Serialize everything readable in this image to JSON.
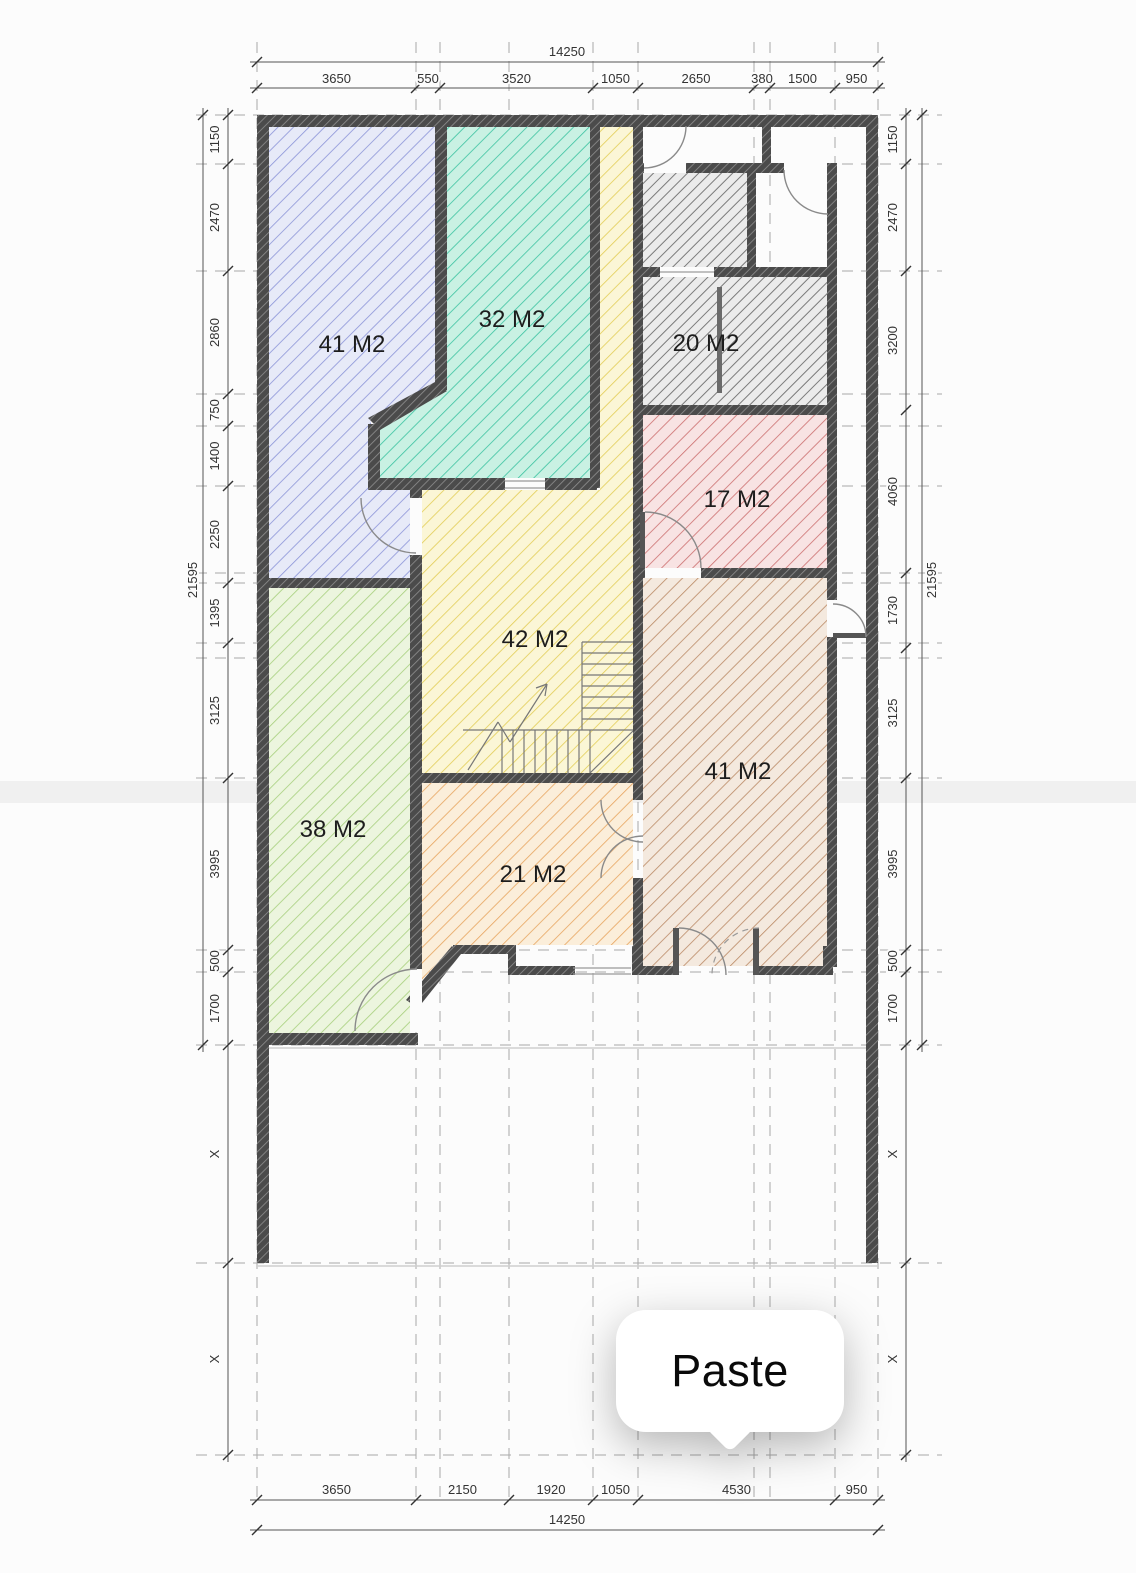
{
  "page": {
    "background": "#fcfcfc",
    "type": "floor-plan-screenshot"
  },
  "paste_menu": {
    "label": "Paste"
  },
  "rooms": [
    {
      "id": "room-blue-top-left",
      "label": "41 M2",
      "fill": "#e7eaf8",
      "hatch": "#8b94d8"
    },
    {
      "id": "room-teal-top",
      "label": "32 M2",
      "fill": "#c9f1e3",
      "hatch": "#3cc3a1"
    },
    {
      "id": "room-gray-top-right",
      "label": "20 M2",
      "fill": "#ebebeb",
      "hatch": "#7a7a7a"
    },
    {
      "id": "room-red-right",
      "label": "17 M2",
      "fill": "#f8e3e3",
      "hatch": "#cc6e6e"
    },
    {
      "id": "room-yellow-center",
      "label": "42 M2",
      "fill": "#fbf6d6",
      "hatch": "#e2cd55"
    },
    {
      "id": "room-brown-right",
      "label": "41 M2",
      "fill": "#f4e9de",
      "hatch": "#bb8a66"
    },
    {
      "id": "room-green-bottom-left",
      "label": "38 M2",
      "fill": "#ecf5de",
      "hatch": "#a6cf7c"
    },
    {
      "id": "room-orange-bottom",
      "label": "21 M2",
      "fill": "#fbeeda",
      "hatch": "#e7a55f"
    }
  ],
  "dimensions": {
    "top": {
      "total": "14250",
      "segments": [
        "3650",
        "550",
        "3520",
        "1050",
        "2650",
        "380",
        "1500",
        "950"
      ]
    },
    "bottom": {
      "total": "14250",
      "segments": [
        "3650",
        "2150",
        "1920",
        "1050",
        "4530",
        "950"
      ]
    },
    "left": {
      "total": "21595",
      "segments": [
        "1150",
        "2470",
        "2860",
        "750",
        "1400",
        "2250",
        "1395",
        "3125",
        "3995",
        "500",
        "1700",
        "X",
        "X"
      ]
    },
    "right": {
      "total": "21595",
      "segments": [
        "1150",
        "2470",
        "3200",
        "4060",
        "1730",
        "3125",
        "3995",
        "500",
        "1700",
        "X",
        "X"
      ]
    }
  },
  "colors": {
    "wall": "#4b4b4b",
    "dimension_text": "#333333",
    "grid_line": "#a9a9a9"
  }
}
